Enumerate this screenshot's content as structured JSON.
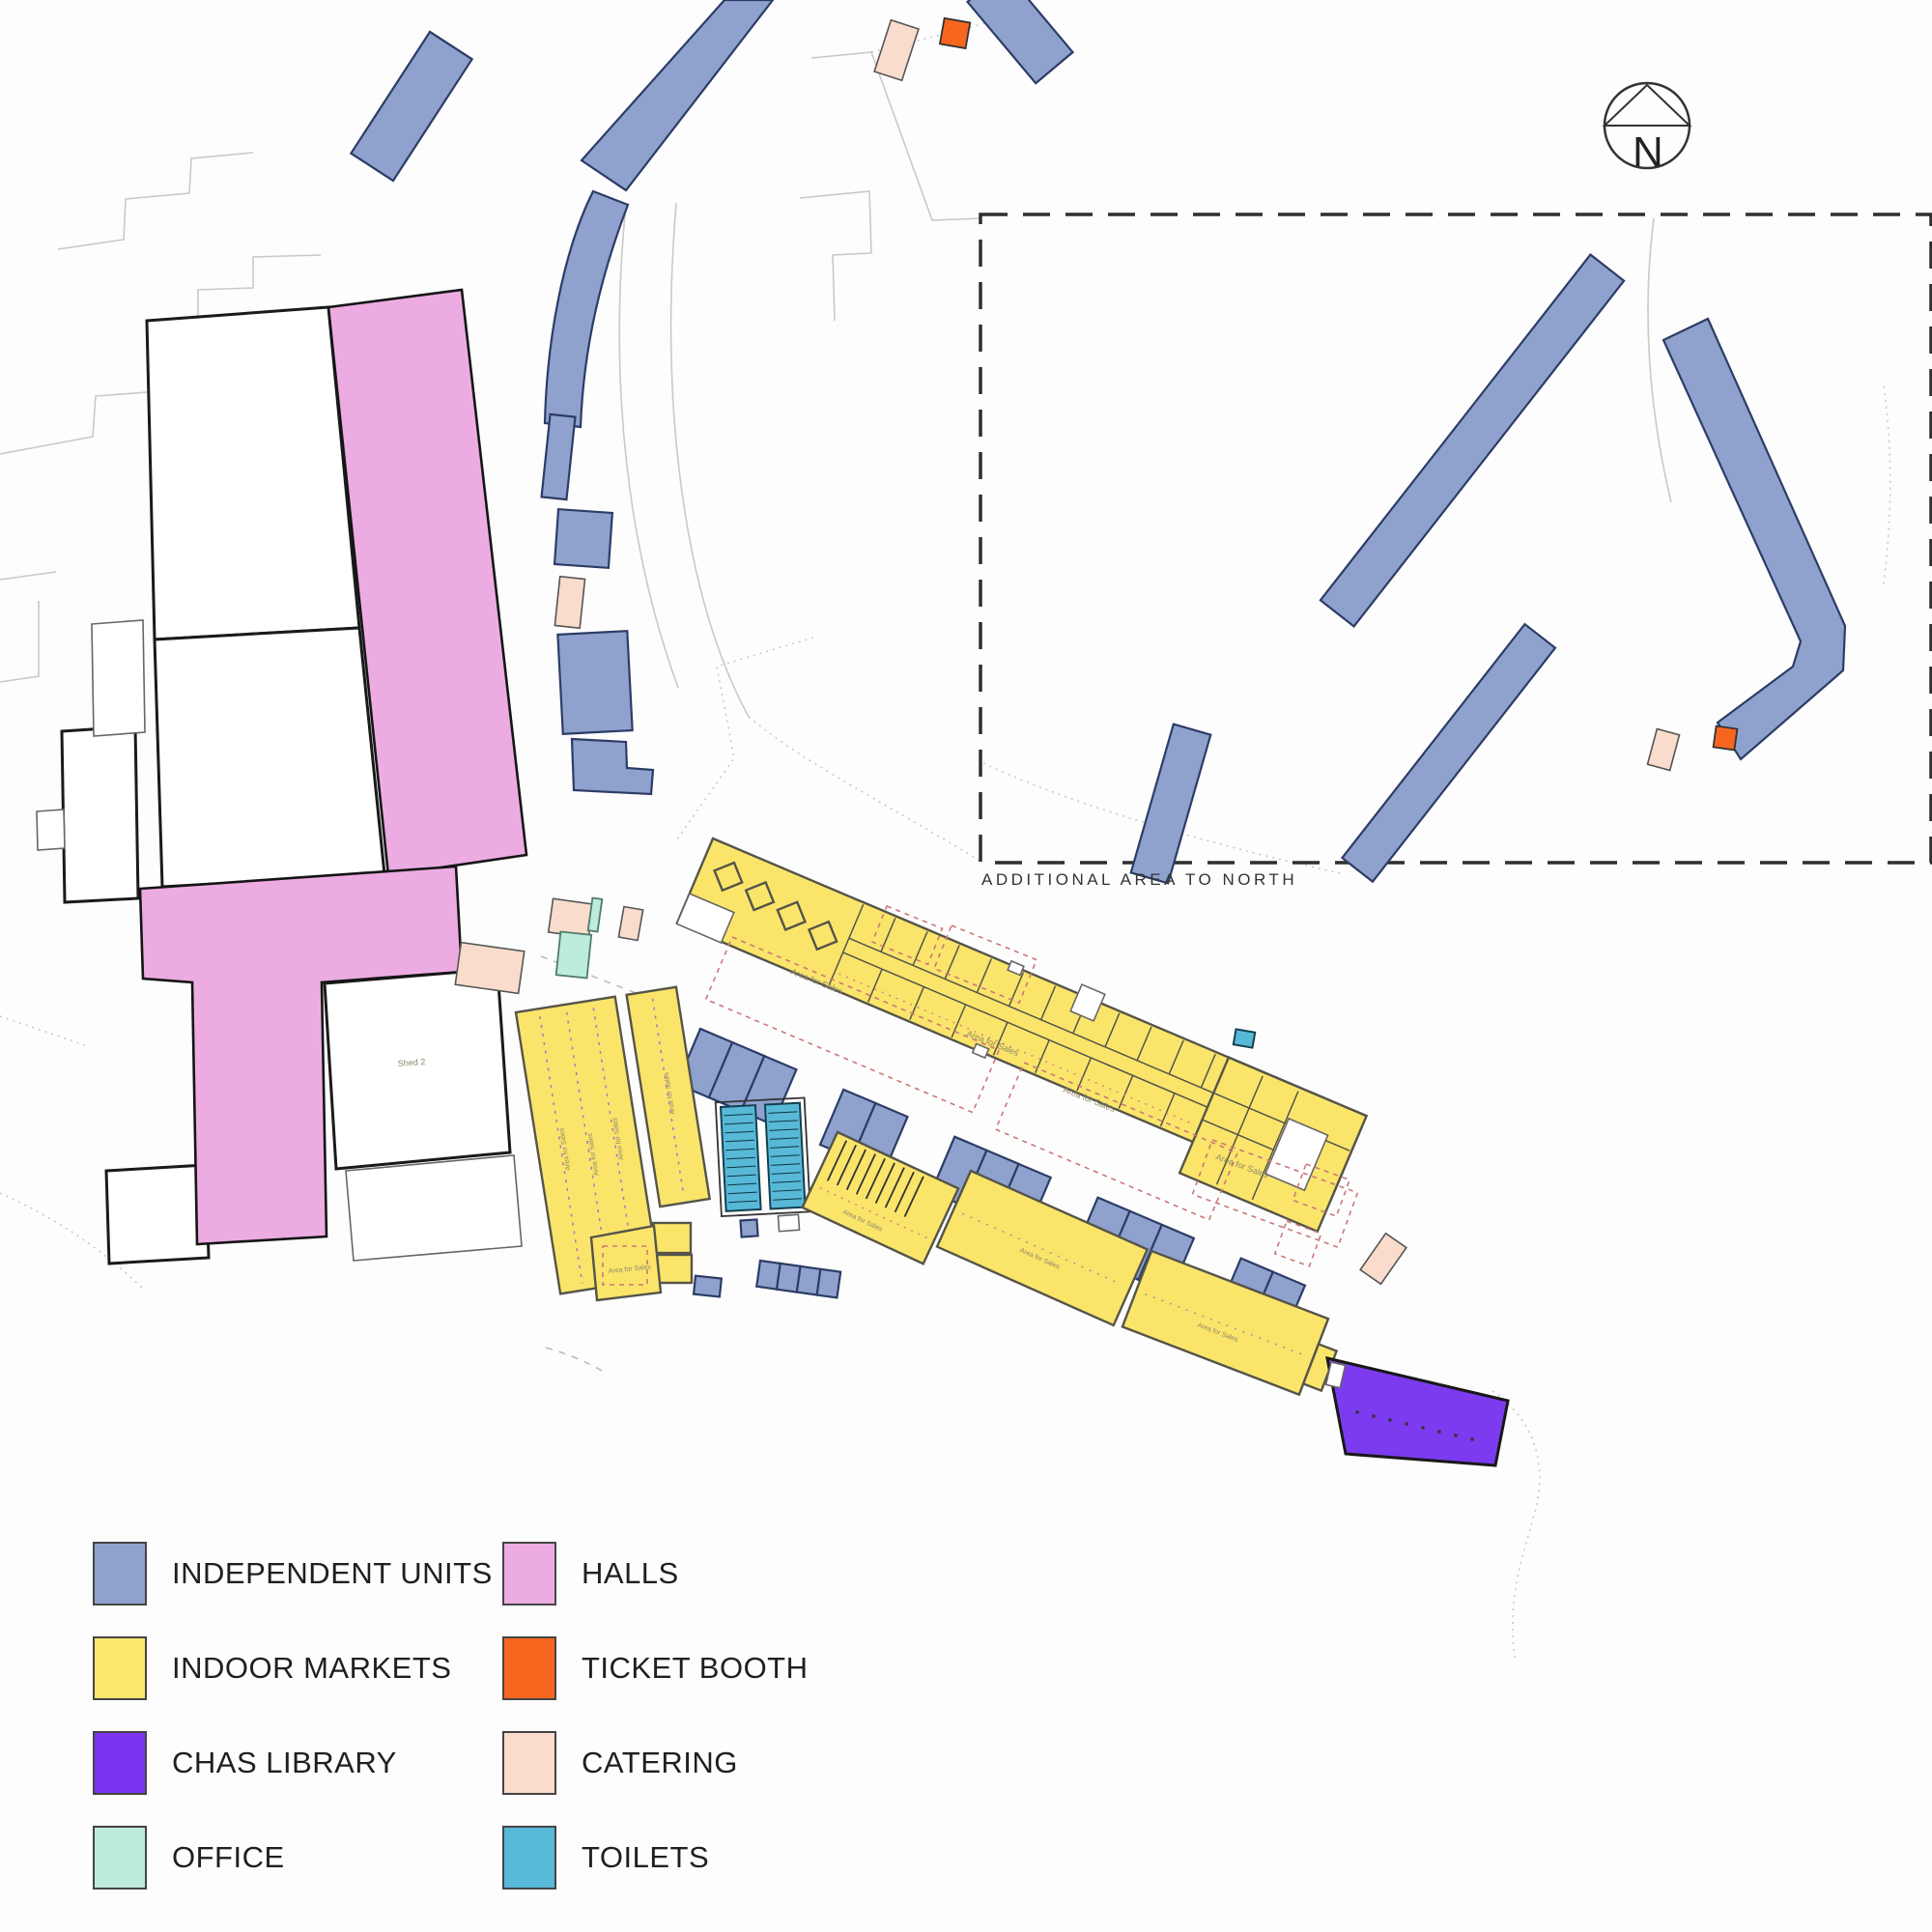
{
  "compass": {
    "label": "N"
  },
  "annotation": {
    "additional_area": "ADDITIONAL AREA TO NORTH"
  },
  "map_labels": {
    "area_for_sales": "Area for Sales",
    "shed": "Shed 2"
  },
  "legend": {
    "items": [
      {
        "id": "independent-units",
        "label": "INDEPENDENT UNITS",
        "color": "#8FA2CE",
        "column": 1
      },
      {
        "id": "indoor-markets",
        "label": "INDOOR MARKETS",
        "color": "#FBE76D",
        "column": 1
      },
      {
        "id": "chas-library",
        "label": "CHAS LIBRARY",
        "color": "#7C33F0",
        "column": 1
      },
      {
        "id": "office",
        "label": "OFFICE",
        "color": "#BDEBDC",
        "column": 1
      },
      {
        "id": "halls",
        "label": "HALLS",
        "color": "#ECACE2",
        "column": 2
      },
      {
        "id": "ticket-booth",
        "label": "TICKET BOOTH",
        "color": "#F7661F",
        "column": 2
      },
      {
        "id": "catering",
        "label": "CATERING",
        "color": "#FADCCC",
        "column": 2
      },
      {
        "id": "toilets",
        "label": "TOILETS",
        "color": "#58B8D8",
        "column": 2
      }
    ]
  },
  "colors": {
    "canvas_bg": "#fdfdfd",
    "independent_units_fill": "#8FA2CE",
    "independent_units_stroke": "#2C3C66",
    "indoor_markets_fill": "#FAE56A",
    "indoor_markets_stroke": "#55544A",
    "halls_fill": "#ECACE2",
    "halls_stroke": "#151515",
    "chas_library_fill": "#7D3BF0",
    "chas_library_stroke": "#181818",
    "office_fill": "#BDEBDC",
    "office_stroke": "#4F7A6D",
    "ticket_booth_fill": "#F7661F",
    "ticket_booth_stroke": "#333333",
    "catering_fill": "#FADCCC",
    "catering_stroke": "#555555",
    "toilets_fill": "#58B8D8",
    "toilets_stroke": "#14404F",
    "white_building_fill": "#FFFFFF",
    "white_building_stroke": "#1A1A1A",
    "faint_line": "#C9C9C9",
    "dashed_boundary": "#2E2E2E",
    "sales_zone_dash": "#CC7777",
    "aisle_dots": "#B277C9",
    "map_label_text": "#8F876A",
    "annotation_text": "#333333",
    "legend_text": "#1F1F1F"
  }
}
